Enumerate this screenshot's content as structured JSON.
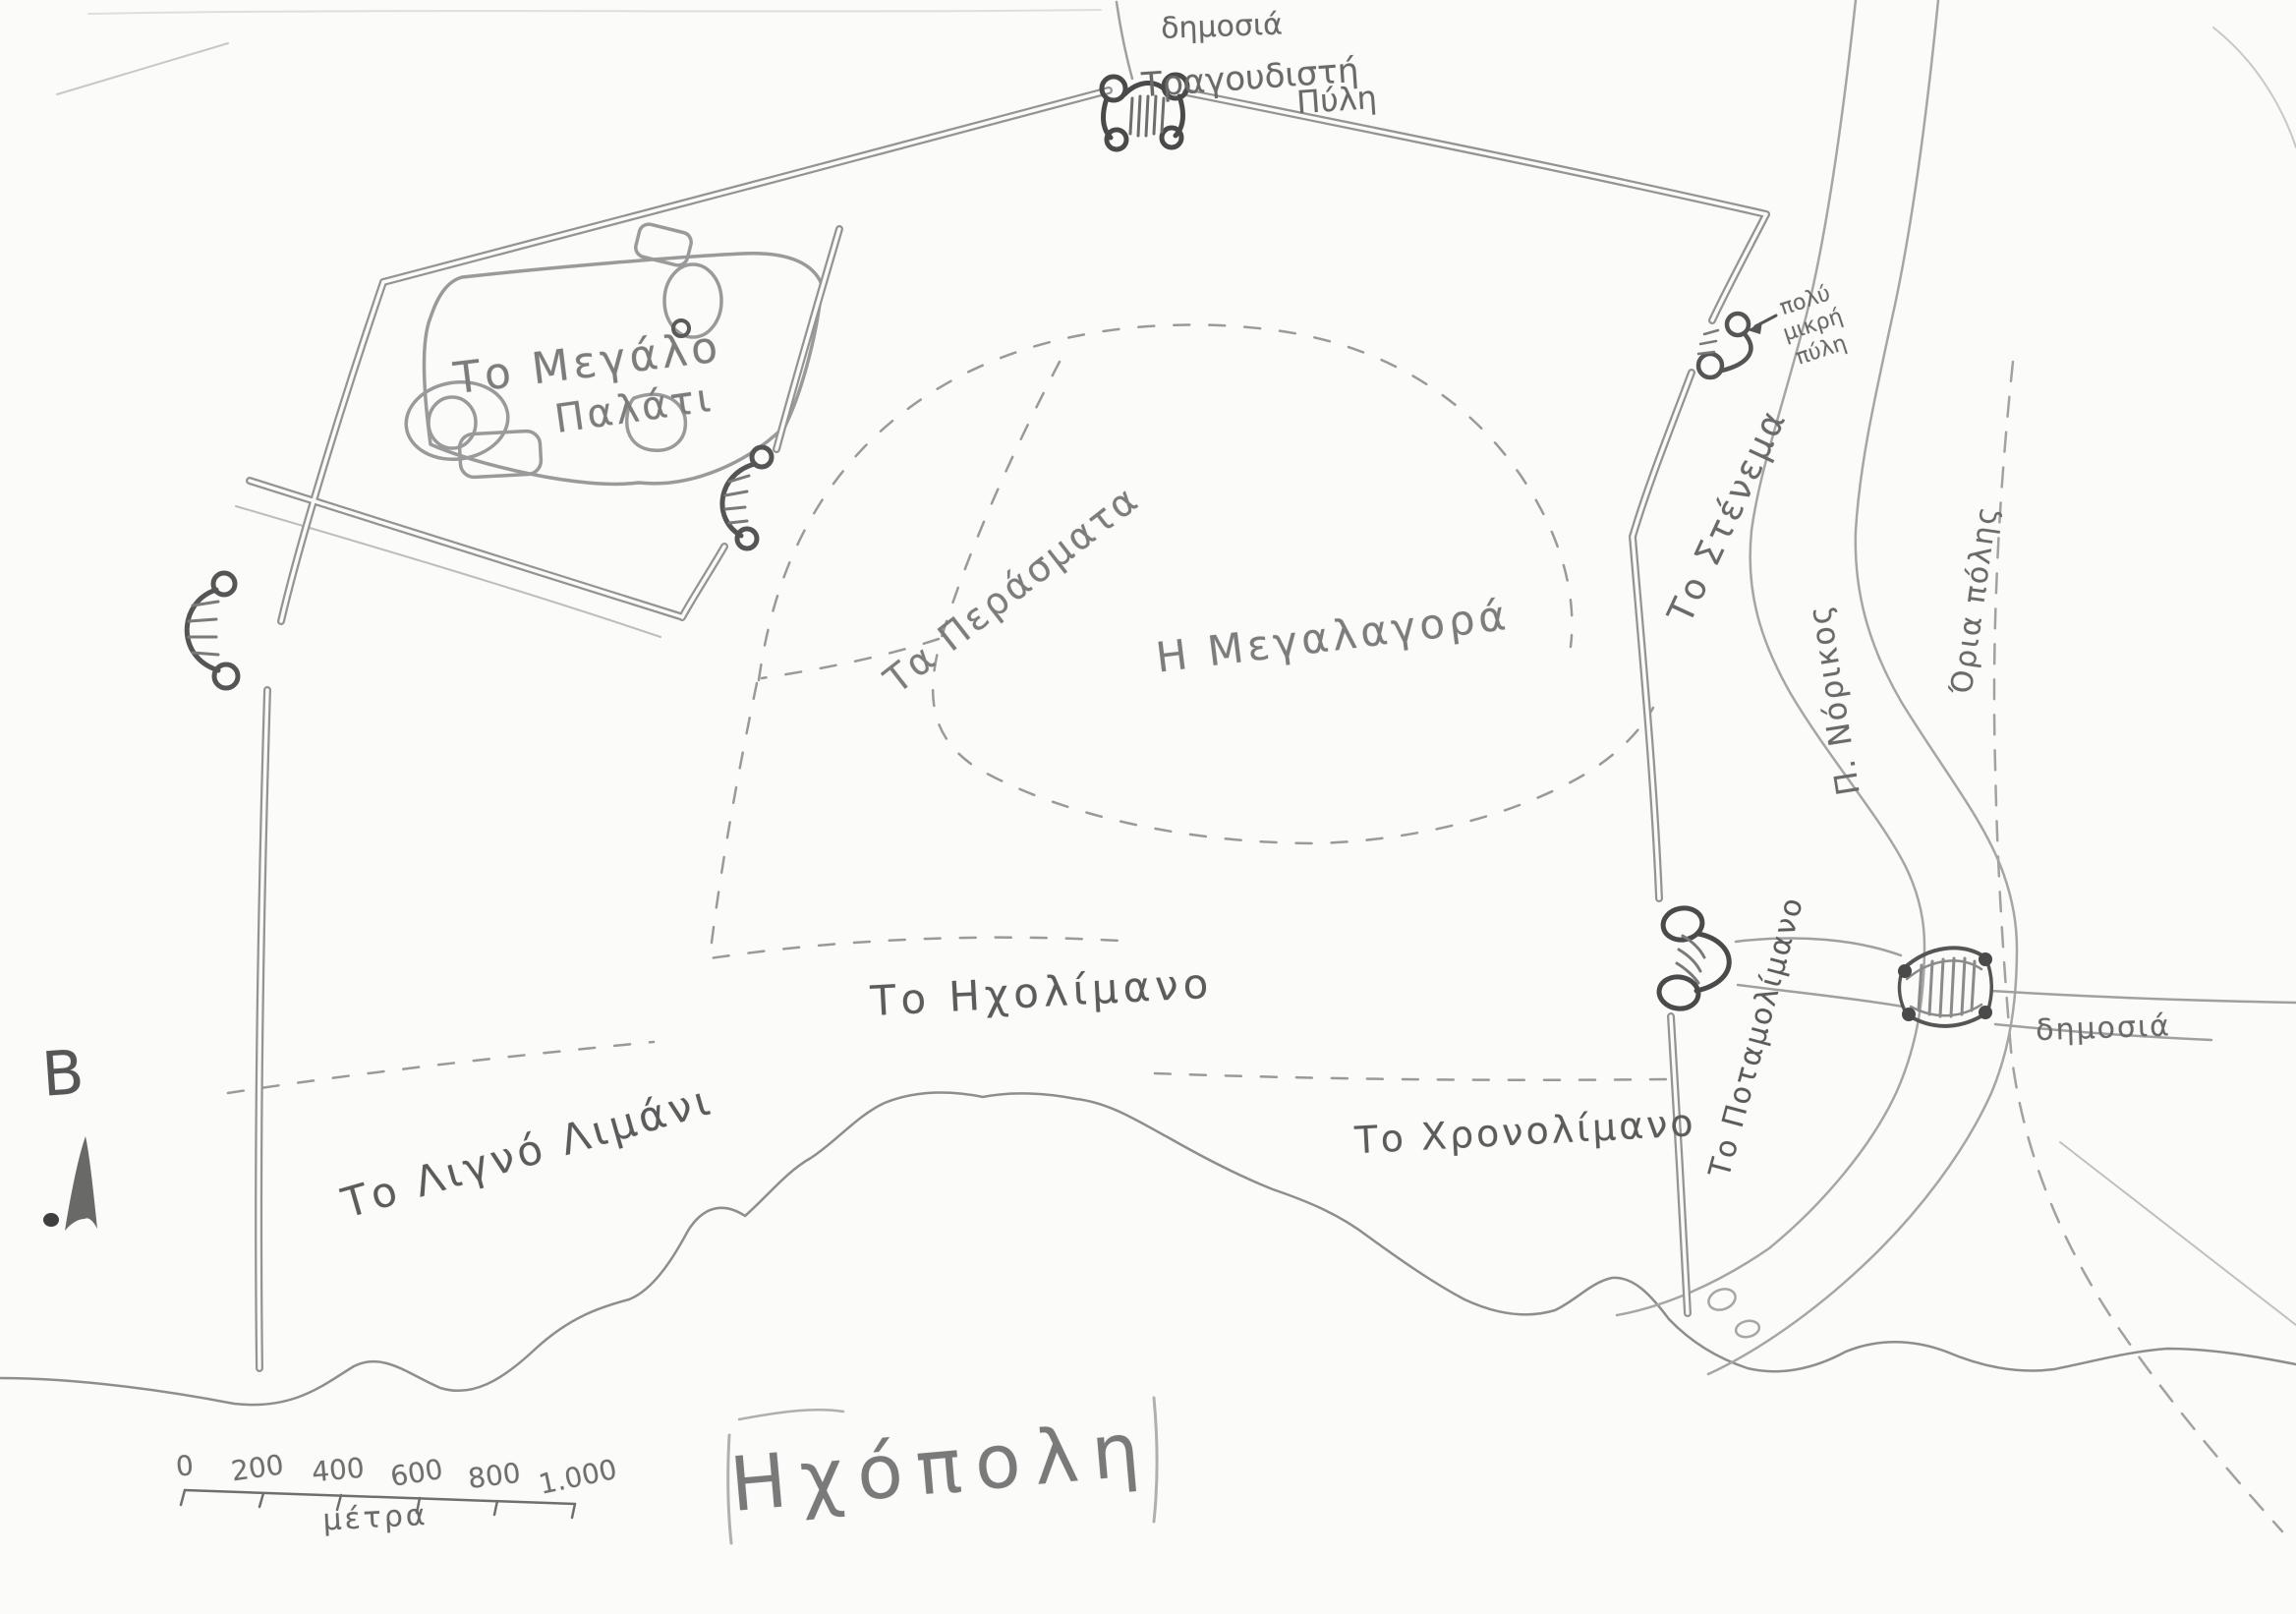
{
  "map": {
    "title": "Ηχόπολη",
    "compass": {
      "north_letter": "Β"
    },
    "scale_bar": {
      "tick_labels": [
        "0",
        "200",
        "400",
        "600",
        "800",
        "1.000"
      ],
      "unit": "μέτρα"
    },
    "labels": {
      "north_road": "δημοσιά",
      "singing_gate_line1": "Τραγουδιστή",
      "singing_gate_line2": "Πύλη",
      "great_palace_line1": "Το Μεγάλο",
      "great_palace_line2": "Παλάτι",
      "passages": "Τα Περάσματα",
      "great_market": "Η Μεγαλαγορά",
      "echo_harbor": "Το Ηχολίμανο",
      "slender_harbor": "Το Λιγνό Λιμάνι",
      "chrono_harbor": "Το Χρονολίμανο",
      "river_harbor": "Το Ποταμολίμανο",
      "narrowing": "Το Στένεμα",
      "river_name": "Π. Νόρικος",
      "city_limits": "Όρια πόλης",
      "tiny_gate": "πολύ\nμικρή\nπύλη",
      "east_road": "δημοσιά"
    },
    "colors": {
      "paper": "#fbfbf9",
      "pencil": "#949494",
      "pencil_dark": "#4f4f4f",
      "text": "#6a6a6a"
    }
  }
}
